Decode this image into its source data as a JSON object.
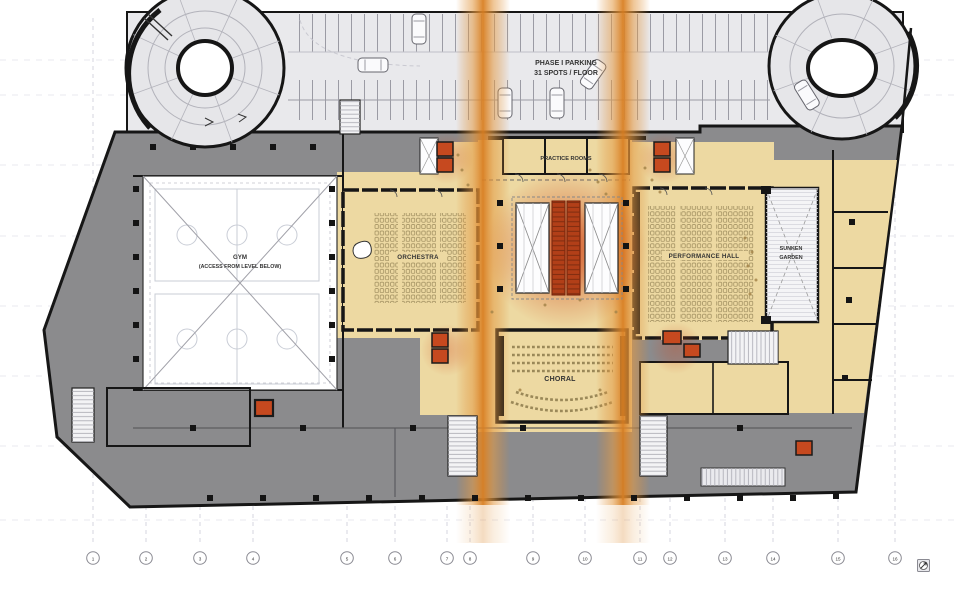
{
  "drawing": {
    "kind": "architectural floor plan",
    "labels": {
      "parking_line1": "PHASE I PARKING",
      "parking_line2": "31 SPOTS / FLOOR",
      "gym_line1": "GYM",
      "gym_line2": "(ACCESS FROM LEVEL BELOW)",
      "orchestra": "ORCHESTRA",
      "performance_hall": "PERFORMANCE HALL",
      "practice_rooms": "PRACTICE ROOMS",
      "choral": "CHORAL",
      "sunken_line1": "SUNKEN",
      "sunken_line2": "GARDEN"
    },
    "grid": {
      "numbers": [
        "1",
        "2",
        "3",
        "4",
        "5",
        "6",
        "7",
        "8",
        "9",
        "10",
        "11",
        "12",
        "13",
        "14",
        "15",
        "16"
      ]
    },
    "colors": {
      "beige": "#EDD9A2",
      "shell_gray": "#8B8B8D",
      "parking_gray": "#E9E9EC",
      "orange_band": "#DD8A2E",
      "red_elevator": "#C6491F",
      "core_red": "#B23F18",
      "glow_red": "#D04418",
      "wall_black": "#161616",
      "grid_line": "#D2D2DC"
    },
    "icons": {
      "north_arrow": "circled-north-arrow"
    }
  }
}
